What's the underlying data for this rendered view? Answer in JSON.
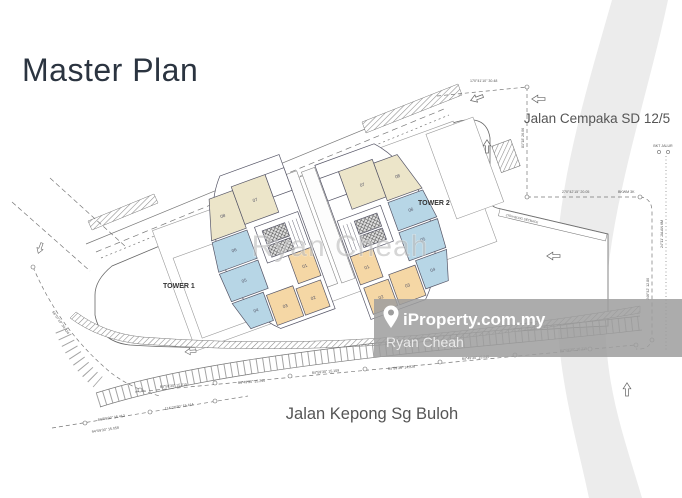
{
  "page": {
    "title": "Master Plan"
  },
  "plan": {
    "road_top": "Jalan Cempaka SD 12/5",
    "road_bottom": "Jalan Kepong Sg Buloh",
    "tower1": {
      "label": "TOWER 1",
      "units": {
        "u1": "01",
        "u2": "02",
        "u3": "03",
        "u4": "04",
        "u5": "05",
        "u6": "06",
        "u7": "07",
        "u8": "08"
      }
    },
    "tower2": {
      "label": "TOWER 2",
      "units": {
        "u1": "01",
        "u2": "02",
        "u3": "03",
        "u4": "04",
        "u5": "05",
        "u6": "06",
        "u7": "07",
        "u8": "08"
      }
    },
    "dims": {
      "d0": "170°41'10\" 30.48",
      "d1": "81°18' 26.06",
      "d2": "270°42'15\" 20.05",
      "d3": "BKWM 3K",
      "d4": "BKT JALUR",
      "d5": "246°42' 12.80",
      "d6": "270m BLDG SETBACK",
      "d7": "84°59'30\" 15.215",
      "d8": "84°49'30\" 15.240",
      "d9": "84°59'30\" 15.109",
      "d10": "84°59'30\" 14.226",
      "d11": "84°59'30\" 16.215",
      "d12": "94°09'30\" 15.058",
      "d13": "84°59'30\" 15.412",
      "d14": "114°28'30\" 15.414",
      "d15": "66°07'10\" 34.424",
      "d16": "24°11' JALAN 6M"
    }
  },
  "watermarks": {
    "center": "Ryan Cheah",
    "brand": "iProperty.com.my",
    "agent": "Ryan Cheah"
  },
  "colors": {
    "title": "#2b3440",
    "unit_beige": "#ece5c9",
    "unit_blue": "#b7d6e6",
    "unit_orange": "#f5d7a5",
    "plan_line": "#777777",
    "watermark_band": "#9e9e9e",
    "swoosh": "#ececec"
  }
}
